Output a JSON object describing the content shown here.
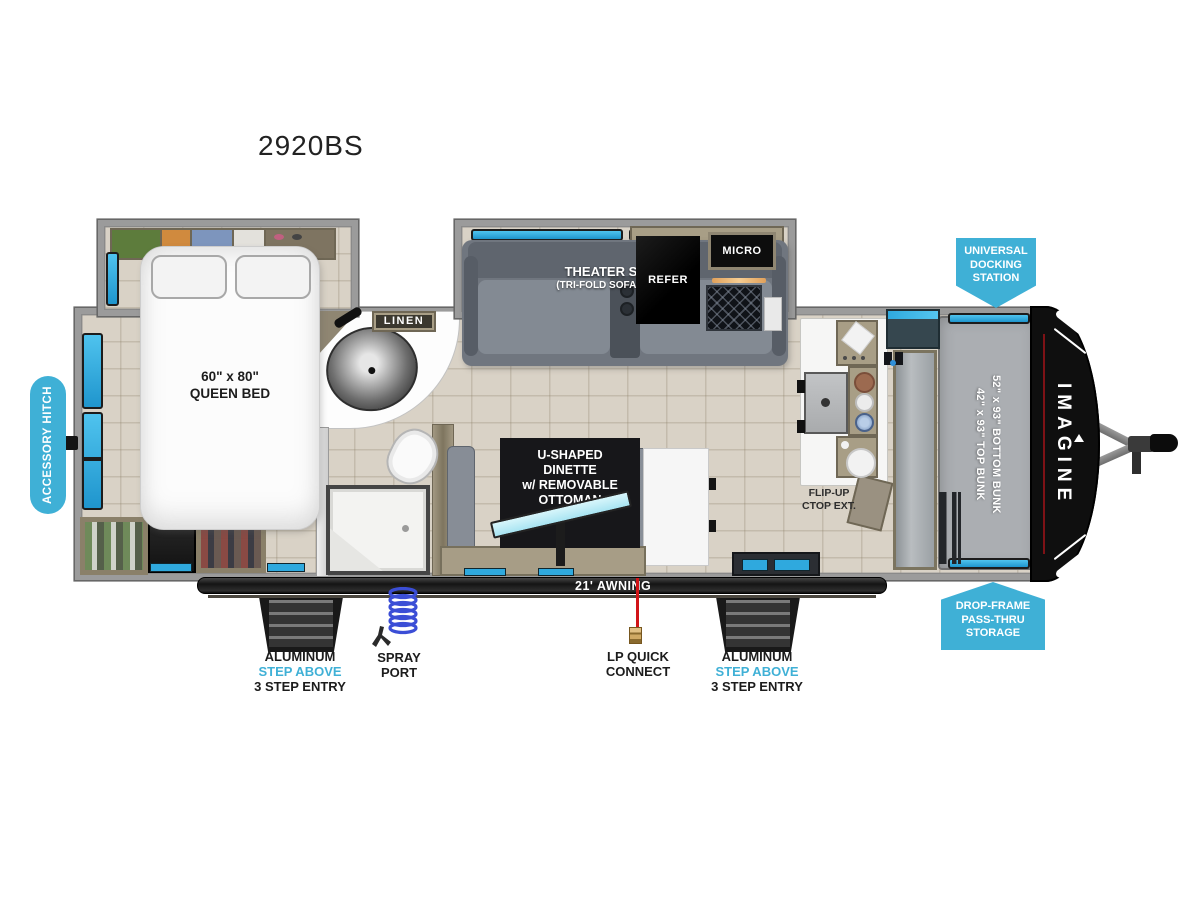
{
  "title": "2920BS",
  "colors": {
    "accent_blue": "#3fb0d6",
    "window_blue": "#2fa9de",
    "table_cyan": "#c9eff8",
    "floor_tan": "#d9d2c6",
    "wall_gray": "#9b9b9b",
    "appliance_black": "#0e0e0e",
    "cabinet_tan": "#a89e86",
    "lp_red": "#d11418",
    "hose_blue": "#3b4ed6"
  },
  "icons": {
    "spray_hose": "coil-hose-icon",
    "lp_connect": "lp-connector-icon",
    "entry_steps": "stairs-icon",
    "hitch": "a-frame-hitch-icon"
  },
  "labels": {
    "accessory_hitch": "ACCESSORY HITCH",
    "queen_bed_size": "60\" x 80\"",
    "queen_bed": "QUEEN BED",
    "linen": "LINEN",
    "theater_seating": "THEATER SEATING",
    "theater_seating_sub": "(TRI-FOLD SOFA OPTIONAL)",
    "refer": "REFER",
    "micro": "MICRO",
    "docking_line1": "UNIVERSAL",
    "docking_line2": "DOCKING",
    "docking_line3": "STATION",
    "top_bunk": "42\" x 93\" TOP BUNK",
    "bottom_bunk": "52\" x 93\" BOTTOM BUNK",
    "brand": "IMAGINE",
    "dinette_line1": "U-SHAPED",
    "dinette_line2": "DINETTE",
    "dinette_line3": "w/ REMOVABLE",
    "dinette_line4": "OTTOMAN",
    "flip_up_line1": "FLIP-UP",
    "flip_up_line2": "CTOP EXT.",
    "storage_line1": "DROP-FRAME",
    "storage_line2": "PASS-THRU",
    "storage_line3": "STORAGE",
    "awning": "21' AWNING",
    "step_line1": "ALUMINUM",
    "step_line2": "STEP ABOVE",
    "step_line3": "3 STEP ENTRY",
    "spray_line1": "SPRAY",
    "spray_line2": "PORT",
    "lp_line1": "LP QUICK",
    "lp_line2": "CONNECT"
  }
}
